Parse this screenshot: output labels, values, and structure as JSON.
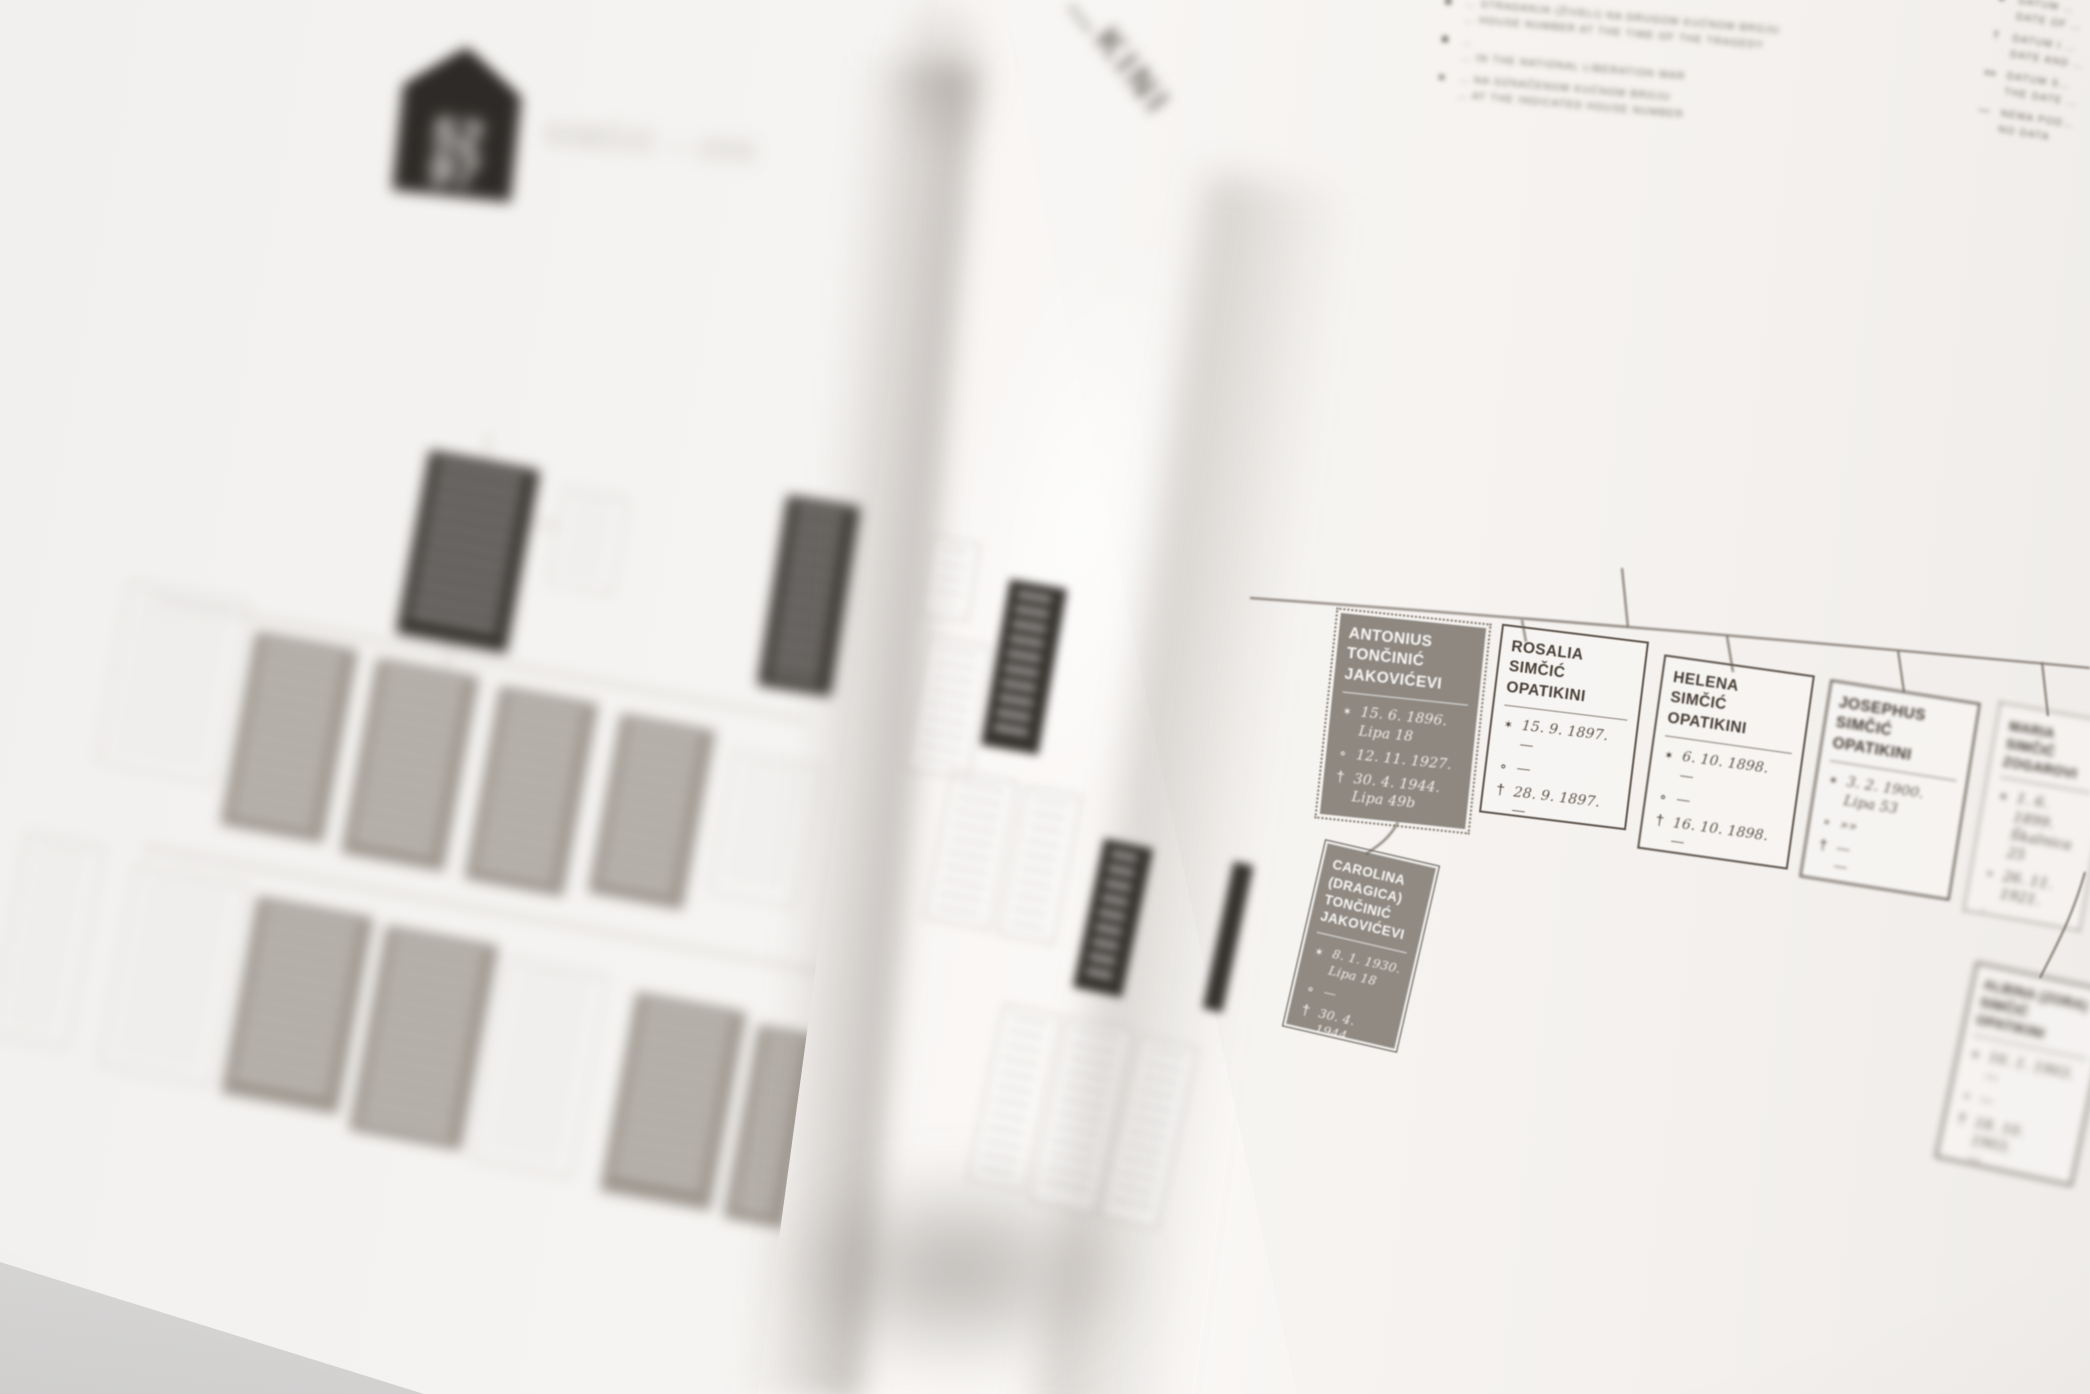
{
  "left_page": {
    "logo": {
      "top_number": "52",
      "bottom_number": "97"
    },
    "title_blurred": "SIMČIĆ – JAK"
  },
  "fold_page": {
    "title_partial": "…KINI"
  },
  "legend": {
    "left": [
      {
        "symbol": "■",
        "hr": "… STRADANJA (ŽIVELI) NA DRUGOM KUĆNOM BROJU",
        "en": "… HOUSE NUMBER AT THE TIME OF THE TRAGEDY"
      },
      {
        "symbol": "■",
        "hr": "…",
        "en": "… IN THE NATIONAL LIBERATION WAR"
      },
      {
        "symbol": "●",
        "hr": "… NA OZNAČENOM KUĆNOM BROJU",
        "en": "… AT THE INDICATED HOUSE NUMBER"
      }
    ],
    "right": [
      {
        "symbol": "●",
        "hr": "DATUM …",
        "en": "DATE OF …"
      },
      {
        "symbol": "†",
        "hr": "DATUM I …",
        "en": "DATE AND …"
      },
      {
        "symbol": "»»",
        "hr": "DATUM S…",
        "en": "THE DATE …"
      },
      {
        "symbol": "—",
        "hr": "NEMA POD…",
        "en": "NO DATA"
      }
    ]
  },
  "symbols": {
    "birth": "✶",
    "marriage": "⚬",
    "death": "†"
  },
  "persons": {
    "antonius": {
      "name": "ANTONIUS\nTONČINIĆ\nJAKOVIĆEVI",
      "birth": "15. 6. 1896.\nLipa 18",
      "marriage": "12. 11. 1927.",
      "death": "30. 4. 1944.\nLipa 49b"
    },
    "rosalia": {
      "name": "ROSALIA\nSIMČIĆ\nOPATIKINI",
      "birth": "15. 9. 1897.\n—",
      "marriage": "—",
      "death": "28. 9. 1897.\n—"
    },
    "helena": {
      "name": "HELENA\nSIMČIĆ\nOPATIKINI",
      "birth": "6. 10. 1898.\n—",
      "marriage": "—",
      "death": "16. 10. 1898.\n—"
    },
    "josephus": {
      "name": "JOSEPHUS\nSIMČIĆ\nOPATIKINI",
      "birth": "3. 2. 1900.\nLipa 53",
      "marriage": "»»",
      "death": "—\n—"
    },
    "maria": {
      "name": "MARIA\nSIMČIĆ\nZOGAROVI",
      "birth": "1. 6. 1899.\nŠkalnica 25",
      "marriage": "26. 11. 1921.",
      "death": "—"
    },
    "carolina": {
      "name": "CAROLINA\n(DRAGICA)\nTONČINIĆ\nJAKOVIĆEVI",
      "birth": "8. 1. 1930.\nLipa 18",
      "marriage": "—",
      "death": "30. 4. 1944.\nLipa 49b"
    },
    "albina": {
      "name": "ALBINA (ZORA)\nSIMČIĆ\nOPATIKINI",
      "birth": "16. 1. 1903.\n—",
      "marriage": "—",
      "death": "18. 10. 1903.\n—"
    }
  },
  "colors": {
    "page": "#f5f2ef",
    "desk": "#d7d6d5",
    "person_box_gray": "#8e8881",
    "person_box_black": "#33302c",
    "ink": "#473e35",
    "date_ink": "#5f554b",
    "connector": "#6a5f55"
  }
}
